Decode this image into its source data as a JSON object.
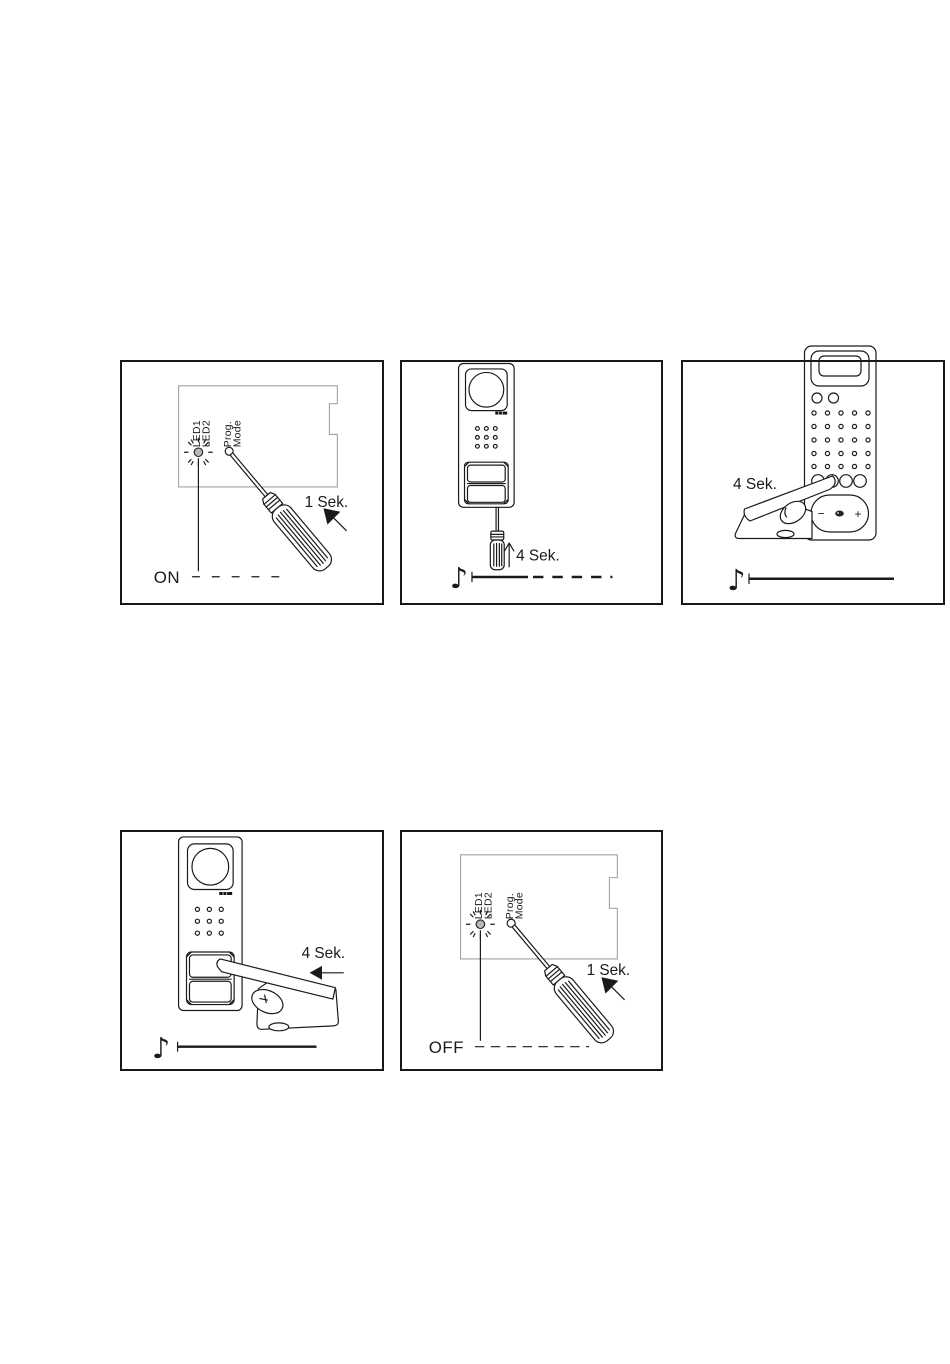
{
  "document": {
    "background": "#ffffff"
  },
  "colors": {
    "line": "#1a1a1a",
    "board_line": "#a3a3a3",
    "led_fill": "#b8b8b8",
    "panel_border": "#181818"
  },
  "panels": {
    "p1": {
      "led1": "LED1",
      "led2": "LED2",
      "prog": "Prog.",
      "mode": "Mode",
      "duration": "1 Sek.",
      "state": "ON"
    },
    "p2": {
      "duration": "4 Sek.",
      "note": "♪"
    },
    "p3": {
      "duration": "4 Sek.",
      "note": "♪",
      "minus": "−",
      "plus": "+"
    },
    "p4": {
      "duration": "4 Sek.",
      "note": "♪"
    },
    "p5": {
      "led1": "LED1",
      "led2": "LED2",
      "prog": "Prog.",
      "mode": "Mode",
      "duration": "1 Sek.",
      "state": "OFF"
    }
  }
}
